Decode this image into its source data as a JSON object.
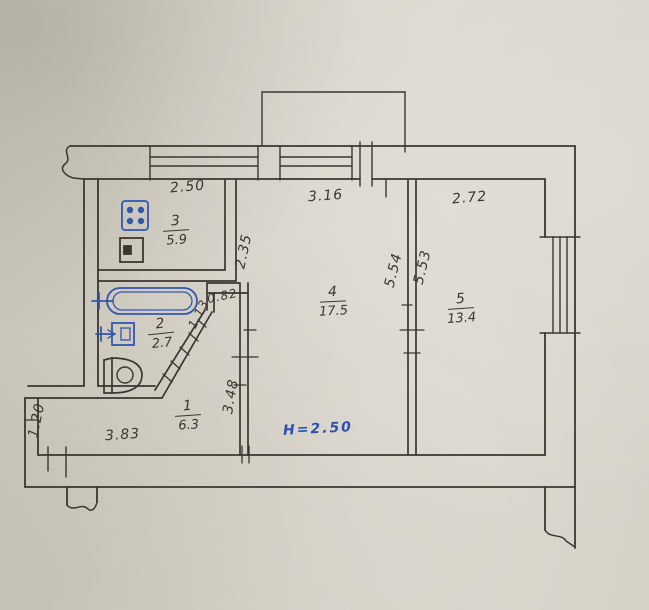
{
  "drawing": {
    "kind": "apartment floor plan (scanned hand drawing)",
    "colors": {
      "paper": "#d7d3c9",
      "ink": "#3b372e",
      "fixture_blue": "#3457ad",
      "note_blue": "#2b50b4"
    }
  },
  "rooms": {
    "r1": {
      "number": "1",
      "area": "6.3"
    },
    "r2": {
      "number": "2",
      "area": "2.7"
    },
    "r3": {
      "number": "3",
      "area": "5.9"
    },
    "r4": {
      "number": "4",
      "area": "17.5"
    },
    "r5": {
      "number": "5",
      "area": "13.4"
    }
  },
  "dimensions": {
    "kitchen_width": "2.50",
    "room4_width": "3.16",
    "room5_width": "2.72",
    "kitchen_depth": "2.35",
    "opening_a": "0.82",
    "opening_b": "1.13",
    "room4_depth": "5.54",
    "room5_depth": "5.53",
    "hall_wall": "3.48",
    "hall_left": "1.20",
    "hall_width": "3.83"
  },
  "note": {
    "ceiling_height": "H=2.50"
  },
  "fixtures": [
    "stove",
    "kitchen-sink",
    "bathtub",
    "washbasin",
    "toilet"
  ],
  "features": [
    "balcony",
    "kitchen-window",
    "room4-window",
    "balcony-door",
    "room5-window",
    "entrance-door",
    "wall-break-marks"
  ]
}
